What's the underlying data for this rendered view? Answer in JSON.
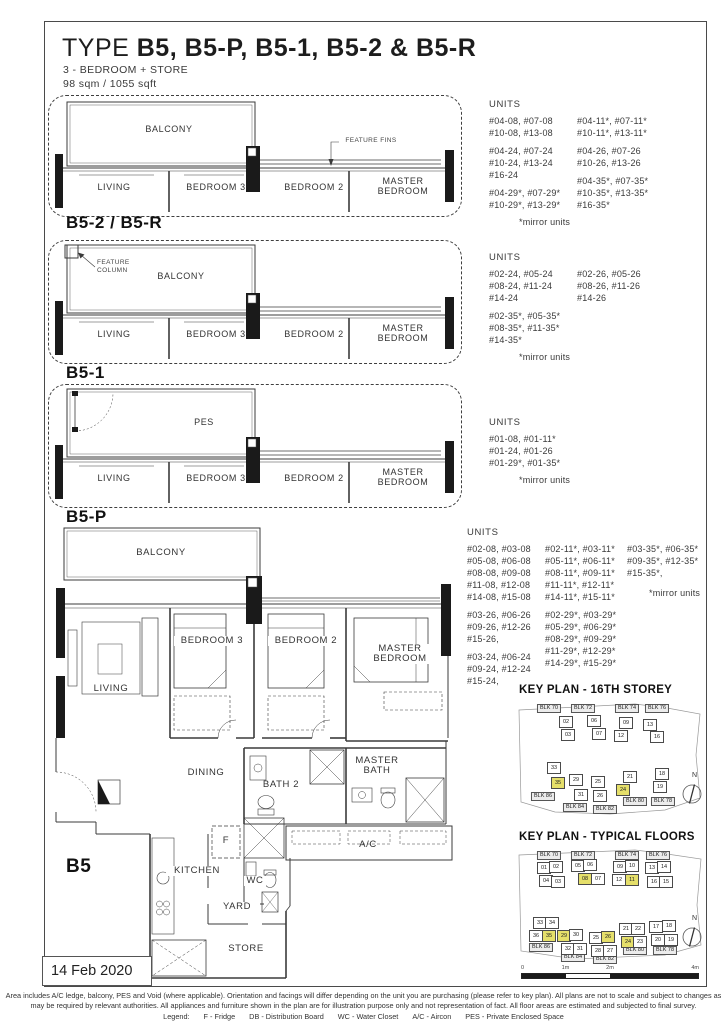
{
  "page": {
    "title_prefix": "TYPE ",
    "title_rest": "B5, B5-P, B5-1, B5-2 & B5-R",
    "subtitle": "3 - BEDROOM + STORE",
    "area": "98 sqm / 1055 sqft",
    "date_stamp": "14 Feb 2020"
  },
  "colors": {
    "highlight": "#e5df6a",
    "line": "#3b3b3b"
  },
  "variants": [
    {
      "name": "B5-2 / B5-R",
      "annotation": "FEATURE FINS",
      "rooms": {
        "outdoor": "BALCONY",
        "living": "LIVING",
        "bedroom3": "BEDROOM 3",
        "bedroom2": "BEDROOM 2",
        "master": "MASTER BEDROOM"
      },
      "units_title": "UNITS",
      "units_col1": [
        "#04-08, #07-08",
        "#10-08, #13-08",
        "",
        "#04-24, #07-24",
        "#10-24, #13-24",
        "#16-24",
        "",
        "#04-29*, #07-29*",
        "#10-29*, #13-29*"
      ],
      "units_col2": [
        "#04-11*, #07-11*",
        "#10-11*, #13-11*",
        "",
        "#04-26, #07-26",
        "#10-26, #13-26",
        "",
        "#04-35*, #07-35*",
        "#10-35*, #13-35*",
        "#16-35*"
      ],
      "mirror_note": "*mirror units"
    },
    {
      "name": "B5-1",
      "annotation": "FEATURE COLUMN",
      "rooms": {
        "outdoor": "BALCONY",
        "living": "LIVING",
        "bedroom3": "BEDROOM 3",
        "bedroom2": "BEDROOM 2",
        "master": "MASTER BEDROOM"
      },
      "units_title": "UNITS",
      "units_col1": [
        "#02-24, #05-24",
        "#08-24, #11-24",
        "#14-24",
        "",
        "#02-35*, #05-35*",
        "#08-35*, #11-35*",
        "#14-35*"
      ],
      "units_col2": [
        "#02-26, #05-26",
        "#08-26, #11-26",
        "#14-26"
      ],
      "mirror_note": "*mirror units"
    },
    {
      "name": "B5-P",
      "annotation": "",
      "rooms": {
        "outdoor": "PES",
        "living": "LIVING",
        "bedroom3": "BEDROOM 3",
        "bedroom2": "BEDROOM 2",
        "master": "MASTER BEDROOM"
      },
      "units_title": "UNITS",
      "units_col1": [
        "#01-08, #01-11*",
        "#01-24, #01-26",
        "#01-29*, #01-35*"
      ],
      "units_col2": [],
      "mirror_note": "*mirror units"
    }
  ],
  "main_plan": {
    "name": "B5",
    "units_title": "UNITS",
    "units_col1": [
      "#02-08, #03-08",
      "#05-08, #06-08",
      "#08-08, #09-08",
      "#11-08, #12-08",
      "#14-08, #15-08",
      "",
      "#03-26, #06-26",
      "#09-26, #12-26",
      "#15-26,",
      "",
      "#03-24, #06-24",
      "#09-24, #12-24",
      "#15-24,"
    ],
    "units_col2": [
      "#02-11*, #03-11*",
      "#05-11*, #06-11*",
      "#08-11*, #09-11*",
      "#11-11*, #12-11*",
      "#14-11*, #15-11*",
      "",
      "#02-29*, #03-29*",
      "#05-29*, #06-29*",
      "#08-29*, #09-29*",
      "#11-29*, #12-29*",
      "#14-29*, #15-29*"
    ],
    "units_col3": [
      "#03-35*, #06-35*",
      "#09-35*, #12-35*",
      "#15-35*,"
    ],
    "mirror_note": "*mirror units",
    "labels": {
      "balcony": "BALCONY",
      "living": "LIVING",
      "bedroom3": "BEDROOM 3",
      "bedroom2": "BEDROOM 2",
      "master_bedroom": "MASTER BEDROOM",
      "dining": "DINING",
      "bath2": "BATH 2",
      "master_bath": "MASTER BATH",
      "ac": "A/C",
      "kitchen": "KITCHEN",
      "fridge": "F",
      "wc": "WC",
      "yard": "YARD",
      "store": "STORE",
      "db": "DB"
    }
  },
  "keyplans": [
    {
      "title": "KEY PLAN - 16TH STOREY",
      "compass_label": "N",
      "blocks": [
        {
          "name": "BLK 70",
          "units": [
            {
              "num": "02"
            },
            {
              "num": "03"
            }
          ]
        },
        {
          "name": "BLK 72",
          "units": [
            {
              "num": "06"
            },
            {
              "num": "07"
            }
          ]
        },
        {
          "name": "BLK 74",
          "units": [
            {
              "num": "09"
            },
            {
              "num": "12"
            }
          ]
        },
        {
          "name": "BLK 76",
          "units": [
            {
              "num": "13"
            },
            {
              "num": "16"
            }
          ]
        },
        {
          "name": "BLK 86",
          "units": [
            {
              "num": "33"
            },
            {
              "num": "35",
              "hl": true
            }
          ]
        },
        {
          "name": "BLK 84",
          "units": [
            {
              "num": "29"
            },
            {
              "num": "31"
            }
          ]
        },
        {
          "name": "BLK 82",
          "units": [
            {
              "num": "25"
            },
            {
              "num": "26"
            }
          ]
        },
        {
          "name": "BLK 80",
          "units": [
            {
              "num": "21"
            },
            {
              "num": "24",
              "hl": true
            }
          ]
        },
        {
          "name": "BLK 78",
          "units": [
            {
              "num": "18"
            },
            {
              "num": "19"
            }
          ]
        }
      ]
    },
    {
      "title": "KEY PLAN - TYPICAL FLOORS",
      "compass_label": "N",
      "scale_labels": [
        "0",
        "1m",
        "2m",
        "4m"
      ],
      "blocks": [
        {
          "name": "BLK 70",
          "units": [
            {
              "num": "01"
            },
            {
              "num": "02"
            },
            {
              "num": "04"
            },
            {
              "num": "03"
            }
          ]
        },
        {
          "name": "BLK 72",
          "units": [
            {
              "num": "05"
            },
            {
              "num": "06"
            },
            {
              "num": "08",
              "hl": true
            },
            {
              "num": "07"
            }
          ]
        },
        {
          "name": "BLK 74",
          "units": [
            {
              "num": "09"
            },
            {
              "num": "10"
            },
            {
              "num": "12"
            },
            {
              "num": "11",
              "hl": true
            }
          ]
        },
        {
          "name": "BLK 76",
          "units": [
            {
              "num": "13"
            },
            {
              "num": "14"
            },
            {
              "num": "16"
            },
            {
              "num": "15"
            }
          ]
        },
        {
          "name": "BLK 86",
          "units": [
            {
              "num": "33"
            },
            {
              "num": "34"
            },
            {
              "num": "36"
            },
            {
              "num": "35",
              "hl": true
            }
          ]
        },
        {
          "name": "BLK 84",
          "units": [
            {
              "num": "29",
              "hl": true
            },
            {
              "num": "30"
            },
            {
              "num": "32"
            },
            {
              "num": "31"
            }
          ]
        },
        {
          "name": "BLK 82",
          "units": [
            {
              "num": "25"
            },
            {
              "num": "26",
              "hl": true
            },
            {
              "num": "28"
            },
            {
              "num": "27"
            }
          ]
        },
        {
          "name": "BLK 80",
          "units": [
            {
              "num": "21"
            },
            {
              "num": "22"
            },
            {
              "num": "24",
              "hl": true
            },
            {
              "num": "23"
            }
          ]
        },
        {
          "name": "BLK 78",
          "units": [
            {
              "num": "17"
            },
            {
              "num": "18"
            },
            {
              "num": "20"
            },
            {
              "num": "19"
            }
          ]
        }
      ]
    }
  ],
  "footer": {
    "disclaimer1": "Area includes A/C ledge, balcony, PES and Void (where applicable). Orientation and facings will differ depending on the unit you are purchasing (please refer to key plan). All plans are not to scale and subject to changes as",
    "disclaimer2": "may be required by relevant authorities. All appliances and furniture shown in the plan are for illustration purpose only and not representation of fact. All floor areas are estimated and subjected to final survey.",
    "legend_label": "Legend:",
    "legend_items": [
      "F - Fridge",
      "DB - Distribution Board",
      "WC - Water Closet",
      "A/C - Aircon",
      "PES - Private Enclosed Space"
    ]
  }
}
